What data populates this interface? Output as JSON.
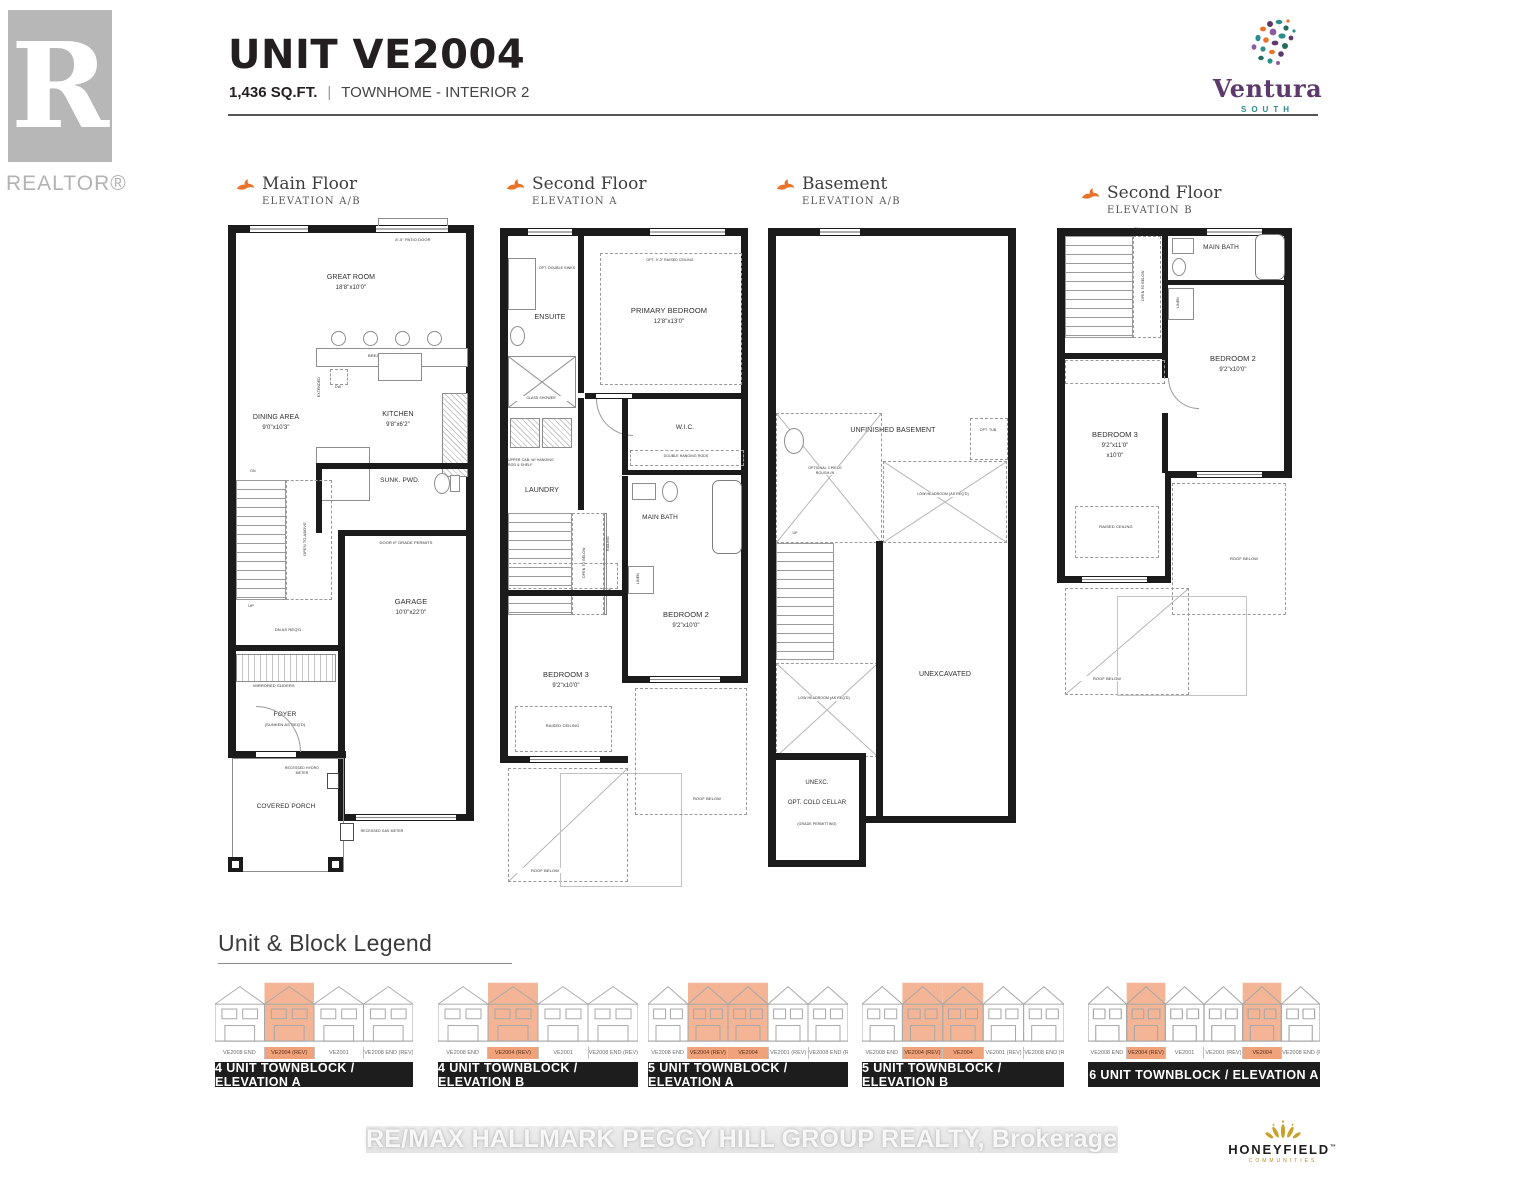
{
  "header": {
    "unit_title": "UNIT VE2004",
    "sqft": "1,436 SQ.FT.",
    "separator": "|",
    "type_label": "TOWNHOME - INTERIOR 2"
  },
  "branding": {
    "realtor_glyph": "R",
    "realtor": "REALTOR®",
    "ventura": "Ventura",
    "ventura_sub": "SOUTH",
    "honeyfield": "HONEYFIELD",
    "honeyfield_tm": "™",
    "honeyfield_sub": "COMMUNITIES"
  },
  "footer": {
    "watermark": "RE/MAX HALLMARK PEGGY HILL GROUP REALTY, Brokerage"
  },
  "colors": {
    "accent_orange": "#E8732A",
    "highlight_orange": "#F0A27A",
    "ventura_purple": "#5C3A6B",
    "ventura_teal": "#2F8C8C",
    "honeyfield_gold": "#C9A22E",
    "wall_black": "#1B1B1B"
  },
  "plans": [
    {
      "title": "Main Floor",
      "elevation": "ELEVATION A/B",
      "labels": {
        "patio_door": "8'-0\" PATIO DOOR",
        "great_room": "GREAT ROOM",
        "great_room_dims": "18'8\"x10'0\"",
        "breakfast_counter": "BREAKFAST COUNTER",
        "extended": "EXTENDED",
        "dw": "DW",
        "dining_area": "DINING AREA",
        "dining_area_dims": "9'0\"x10'3\"",
        "kitchen": "KITCHEN",
        "kitchen_dims": "9'8\"x6'2\"",
        "sunk_pwd": "SUNK. PWD.",
        "open_to_above": "OPEN TO ABOVE",
        "up": "UP",
        "dn": "DN",
        "dn_as_reqd": "DN AS REQ'D",
        "door_if_grade": "DOOR IF GRADE PERMITS",
        "garage": "GARAGE",
        "garage_dims": "10'0\"x22'0\"",
        "mirrored_sliders": "MIRRORED SLIDERS",
        "foyer": "FOYER",
        "foyer_sub": "(SUNKEN AS REQ'D)",
        "covered_porch": "COVERED PORCH",
        "recessed_hydro": "RECESSED HYDRO METER",
        "recessed_gas": "RECESSED GAS METER"
      }
    },
    {
      "title": "Second Floor",
      "elevation": "ELEVATION A",
      "labels": {
        "opt_double_sinks": "OPT. DOUBLE SINKS",
        "ensuite": "ENSUITE",
        "glass_shower": "GLASS SHOWER",
        "opt_raised_ceiling": "OPT. 9'-0\" RAISED CEILING",
        "primary_bedroom": "PRIMARY BEDROOM",
        "primary_bedroom_dims": "12'8\"x13'0\"",
        "wic": "W.I.C.",
        "double_hanging_rods": "DOUBLE HANGING RODS",
        "upper_cab": "UPPER CAB. W/ HANGING ROD & SHELF",
        "laundry": "LAUNDRY",
        "main_bath": "MAIN BATH",
        "linen": "LINEN",
        "open_to_below": "OPEN TO BELOW",
        "railing": "RAILING",
        "dn": "DN",
        "bedroom2": "BEDROOM 2",
        "bedroom2_dims": "9'2\"x10'0\"",
        "bedroom3": "BEDROOM 3",
        "bedroom3_dims": "9'2\"x10'0\"",
        "raised_ceiling": "RAISED CEILING",
        "roof_below": "ROOF BELOW",
        "roof_below2": "ROOF BELOW"
      }
    },
    {
      "title": "Basement",
      "elevation": "ELEVATION A/B",
      "labels": {
        "unfinished_basement": "UNFINISHED BASEMENT",
        "opt_tub": "OPT. TUB",
        "optional_rough_in": "OPTIONAL 3 PIECE ROUGH-IN",
        "low_headroom_1": "LOW HEADROOM (AS REQ'D)",
        "low_headroom_2": "LOW HEADROOM (AS REQ'D)",
        "up": "UP",
        "unexcavated": "UNEXCAVATED",
        "unexc": "UNEXC.",
        "opt_cold_cellar": "OPT. COLD CELLAR",
        "grade_permitting": "(GRADE PERMITTING)"
      }
    },
    {
      "title": "Second Floor",
      "elevation": "ELEVATION B",
      "labels": {
        "main_bath": "MAIN BATH",
        "linen": "LINEN",
        "open_to_below": "OPEN TO BELOW",
        "dn": "DN",
        "bedroom2": "BEDROOM 2",
        "bedroom2_dims": "9'2\"x10'0\"",
        "bedroom3": "BEDROOM 3",
        "bedroom3_dims": "9'2\"x11'0\"",
        "bedroom3_dims2": "x10'0\"",
        "raised_ceiling": "RAISED CEILING",
        "roof_below": "ROOF BELOW",
        "roof_below2": "ROOF BELOW"
      }
    }
  ],
  "legend": {
    "title": "Unit & Block Legend",
    "blocks": [
      {
        "label": "4 UNIT TOWNBLOCK / ELEVATION A",
        "units": [
          {
            "name": "VE2008 END",
            "highlight": false
          },
          {
            "name": "VE2004 (REV)",
            "highlight": true
          },
          {
            "name": "VE2001",
            "highlight": false
          },
          {
            "name": "VE2008 END (REV)",
            "highlight": false
          }
        ]
      },
      {
        "label": "4 UNIT TOWNBLOCK / ELEVATION B",
        "units": [
          {
            "name": "VE2008 END",
            "highlight": false
          },
          {
            "name": "VE2004 (REV)",
            "highlight": true
          },
          {
            "name": "VE2001",
            "highlight": false
          },
          {
            "name": "VE2008 END (REV)",
            "highlight": false
          }
        ]
      },
      {
        "label": "5 UNIT TOWNBLOCK / ELEVATION A",
        "units": [
          {
            "name": "VE2008 END",
            "highlight": false
          },
          {
            "name": "VE2004 (REV)",
            "highlight": true
          },
          {
            "name": "VE2004",
            "highlight": true
          },
          {
            "name": "VE2001 (REV)",
            "highlight": false
          },
          {
            "name": "VE2008 END (REV)",
            "highlight": false
          }
        ]
      },
      {
        "label": "5 UNIT TOWNBLOCK / ELEVATION B",
        "units": [
          {
            "name": "VE2008 END",
            "highlight": false
          },
          {
            "name": "VE2004 (REV)",
            "highlight": true
          },
          {
            "name": "VE2004",
            "highlight": true
          },
          {
            "name": "VE2001 (REV)",
            "highlight": false
          },
          {
            "name": "VE2008 END (REV)",
            "highlight": false
          }
        ]
      },
      {
        "label": "6 UNIT TOWNBLOCK / ELEVATION A",
        "units": [
          {
            "name": "VE2008 END",
            "highlight": false
          },
          {
            "name": "VE2004 (REV)",
            "highlight": true
          },
          {
            "name": "VE2001",
            "highlight": false
          },
          {
            "name": "VE2001 (REV)",
            "highlight": false
          },
          {
            "name": "VE2004",
            "highlight": true
          },
          {
            "name": "VE2008 END (REV)",
            "highlight": false
          }
        ]
      }
    ]
  }
}
